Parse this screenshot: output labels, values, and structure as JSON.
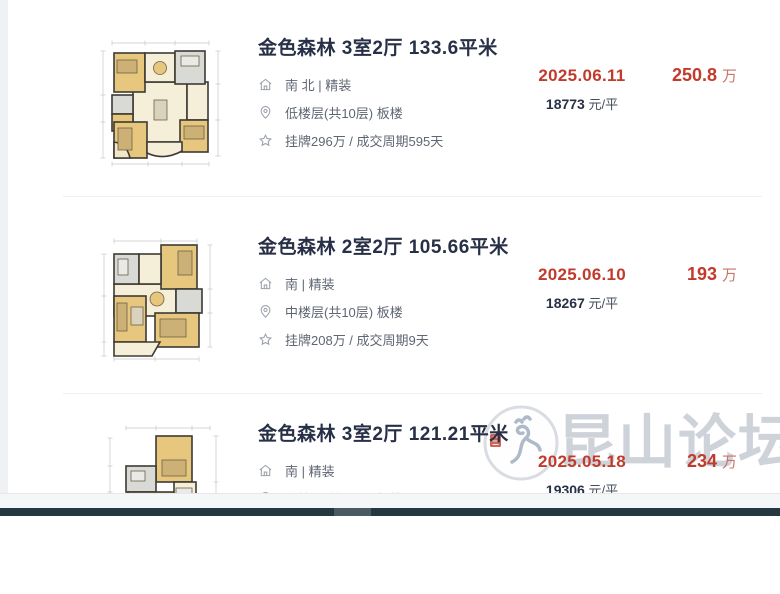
{
  "listings": [
    {
      "title": "金色森林 3室2厅 133.6平米",
      "orientation": "南 北 | 精装",
      "floor": "低楼层(共10层) 板楼",
      "listing_info": "挂牌296万 / 成交周期595天",
      "deal_date": "2025.06.11",
      "unit_price": "18773",
      "unit_price_suffix": "元/平",
      "total_price": "250.8",
      "total_price_unit": "万",
      "thumbnail": "floor-plan-3room-133"
    },
    {
      "title": "金色森林 2室2厅 105.66平米",
      "orientation": "南 | 精装",
      "floor": "中楼层(共10层) 板楼",
      "listing_info": "挂牌208万 / 成交周期9天",
      "deal_date": "2025.06.10",
      "unit_price": "18267",
      "unit_price_suffix": "元/平",
      "total_price": "193",
      "total_price_unit": "万",
      "thumbnail": "floor-plan-2room-105"
    },
    {
      "title": "金色森林 3室2厅 121.21平米",
      "orientation": "南 | 精装",
      "floor": "低楼层(共10层) 板楼",
      "deal_date": "2025.05.18",
      "unit_price": "19306",
      "unit_price_suffix": "元/平",
      "total_price": "234",
      "total_price_unit": "万",
      "thumbnail": "floor-plan-3room-121"
    }
  ],
  "watermark": {
    "text": "昆山论坛"
  },
  "icons": {
    "orientation_row": "house-icon",
    "floor_row": "location-pin-icon",
    "listing_row": "star-icon"
  },
  "colors": {
    "accent_red": "#c23a2b",
    "price_unit_red": "#c9756a",
    "title_dark": "#273046",
    "detail_gray": "#5f6673",
    "watermark_gray": "#bdc4ce",
    "scrollbar_track": "#253741",
    "scrollbar_thumb": "#4a5a63"
  }
}
